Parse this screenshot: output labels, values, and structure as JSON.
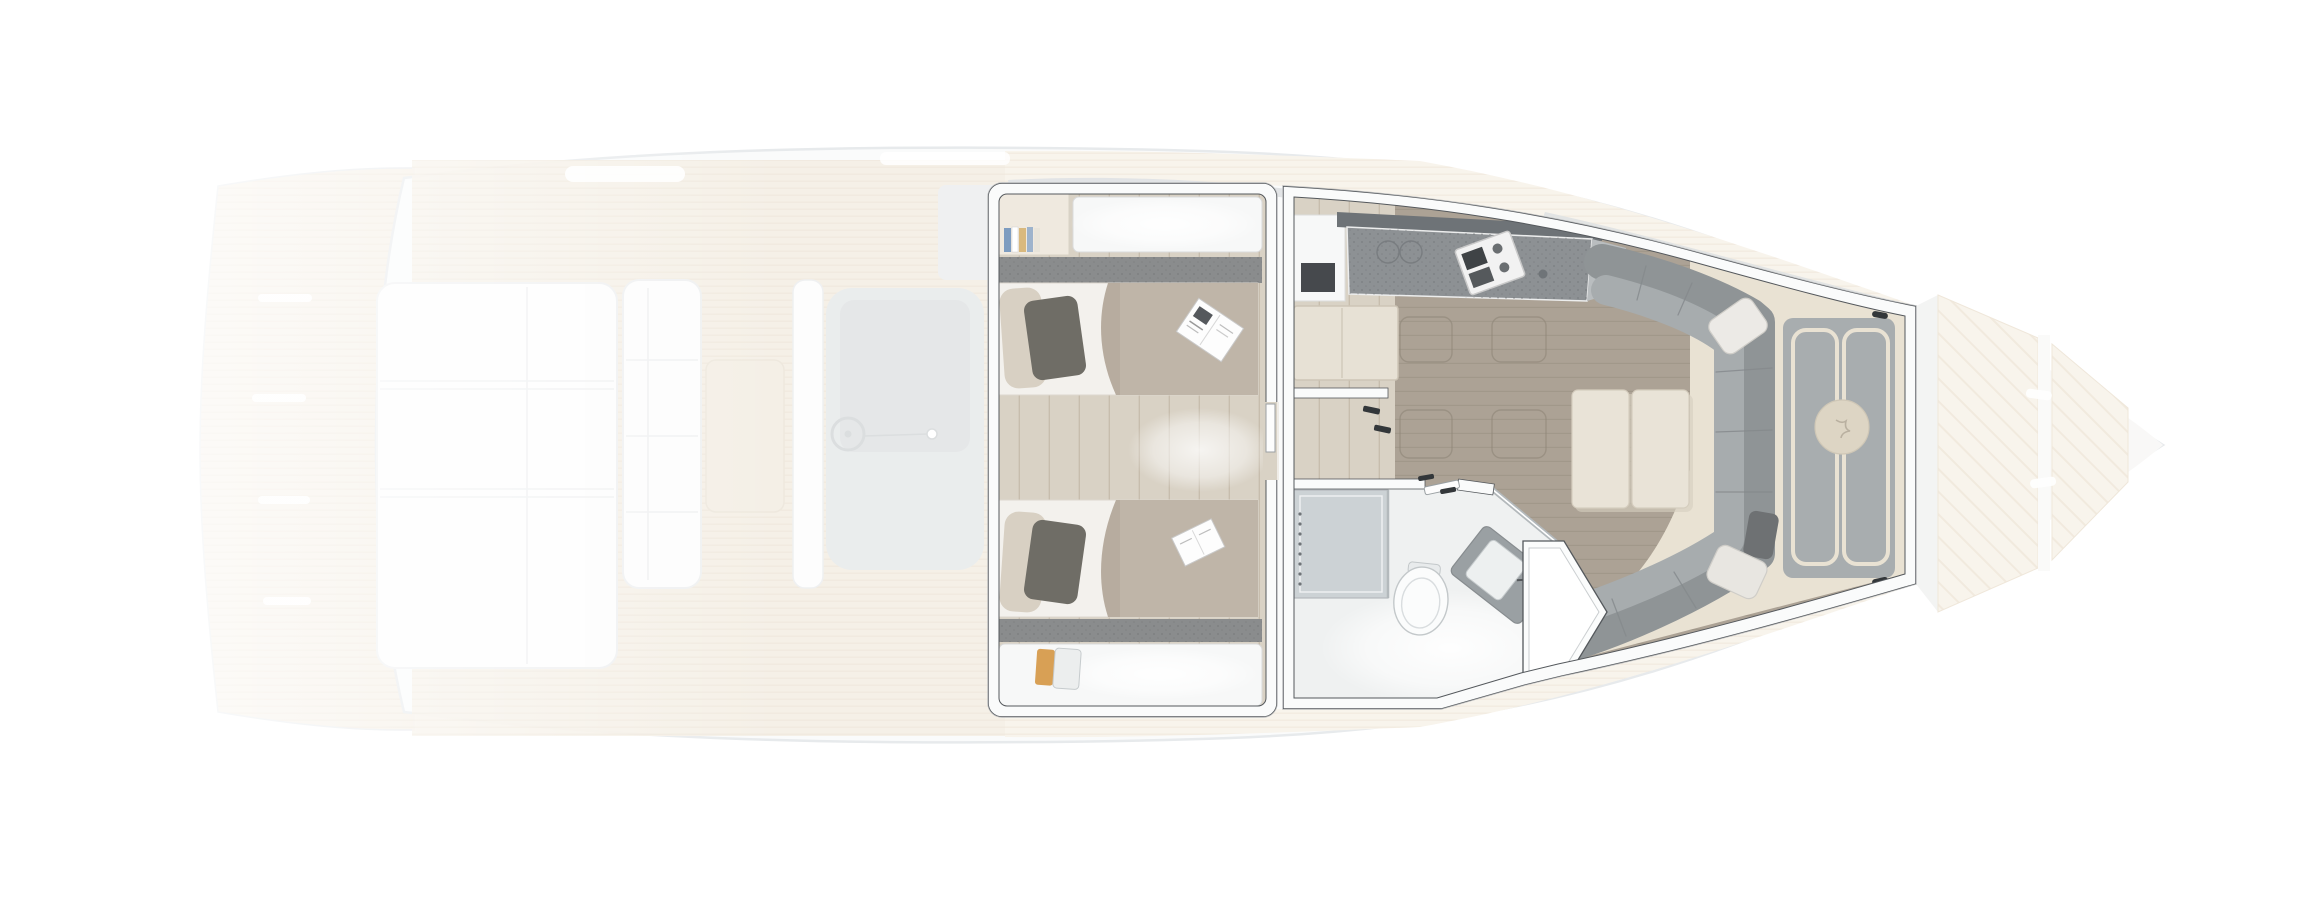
{
  "colors": {
    "bg": "#ffffff",
    "hull_fill": "#f3f5f6",
    "hull_stroke": "#c6ccd1",
    "gunwale_gray": "#b4babd",
    "teak": "#e7d9c2",
    "teak_stripe": "#d9c6a8",
    "teak_light": "#efe4d2",
    "sunpad_fill": "#fafbfb",
    "pad_line": "#d8dcde",
    "console_gray": "#ced3d5",
    "console_inner": "#c2c7c9",
    "windshield_gray": "#b9bfc3",
    "wall_fill": "#fafbfb",
    "wall_edge": "#54585c",
    "floor_walkway": "#d9d2c5",
    "plank_line": "#c4baa9",
    "salon_floor": "#aca295",
    "salon_plank": "#9c9285",
    "hatch_line": "#8f8678",
    "carpet": "#8a8c8d",
    "carpet_dot": "#737678",
    "counter_lip": "#6e7377",
    "counter_top": "#8d9194",
    "cabinet_white": "#f7f8f8",
    "appliance_dark": "#46494d",
    "desk_cream": "#e7e1d5",
    "desk_edge": "#cdc5b6",
    "mattress": "#cdc6b9",
    "duvet": "#b7ac9f",
    "sheet_white": "#f3f1ed",
    "pillow_dark": "#6f6d66",
    "pillow_cream": "#d8d0c3",
    "sofa_back": "#8f9496",
    "sofa_seat": "#a7acae",
    "sofa_seam": "#85898c",
    "table_cream": "#e9e3d7",
    "bed_gray": "#a8adaf",
    "bed_trim": "#e9e2d3",
    "cushion_cream": "#ddd5c4",
    "bath_floor": "#eff1f1",
    "shower_tint": "#c9cfd2",
    "fixture_white": "#fbfcfc",
    "fixture_stroke": "#b6bbbe",
    "vanity_gray": "#9aa0a3",
    "glass_line": "#b3b9bc",
    "mark_dark": "#33373a",
    "book_blue": "#7d9cc0",
    "book_tan": "#d9b97e",
    "stool_tan": "#d8a055",
    "fade": "rgba(255,255,255,0.58)"
  },
  "plan": {
    "vessel_view": "top-down-deck-plan",
    "regions": [
      {
        "id": "swim-platform",
        "zone": "aft",
        "faded": true
      },
      {
        "id": "cockpit",
        "zone": "aft",
        "faded": true
      },
      {
        "id": "mid-cabin",
        "zone": "lower-deck",
        "faded": false
      },
      {
        "id": "galley",
        "zone": "lower-deck",
        "faded": false
      },
      {
        "id": "salon",
        "zone": "lower-deck",
        "faded": false
      },
      {
        "id": "bathroom",
        "zone": "lower-deck",
        "faded": false
      },
      {
        "id": "bow-cabin",
        "zone": "lower-deck",
        "faded": false
      },
      {
        "id": "bow-deck",
        "zone": "fore",
        "faded": true
      }
    ],
    "fixtures": [
      "aft-sunpad",
      "cockpit-bench",
      "cockpit-table",
      "helm-console",
      "steering-wheel",
      "bookshelf",
      "wardrobe-top",
      "wardrobe-bottom",
      "twin-berth-top",
      "twin-berth-bottom",
      "magazine",
      "book",
      "step-stool",
      "carpet-runner-top",
      "carpet-runner-bottom",
      "companionway-desk",
      "galley-appliance",
      "galley-counter",
      "galley-sink",
      "cooktop",
      "floor-hatches",
      "u-sofa",
      "sofa-pillows",
      "salon-table",
      "shower",
      "toilet",
      "vanity-sink",
      "glass-partition",
      "bathroom-door",
      "bow-berth",
      "berth-runners",
      "round-cushion",
      "reading-lights",
      "teak-bow-panels"
    ]
  }
}
